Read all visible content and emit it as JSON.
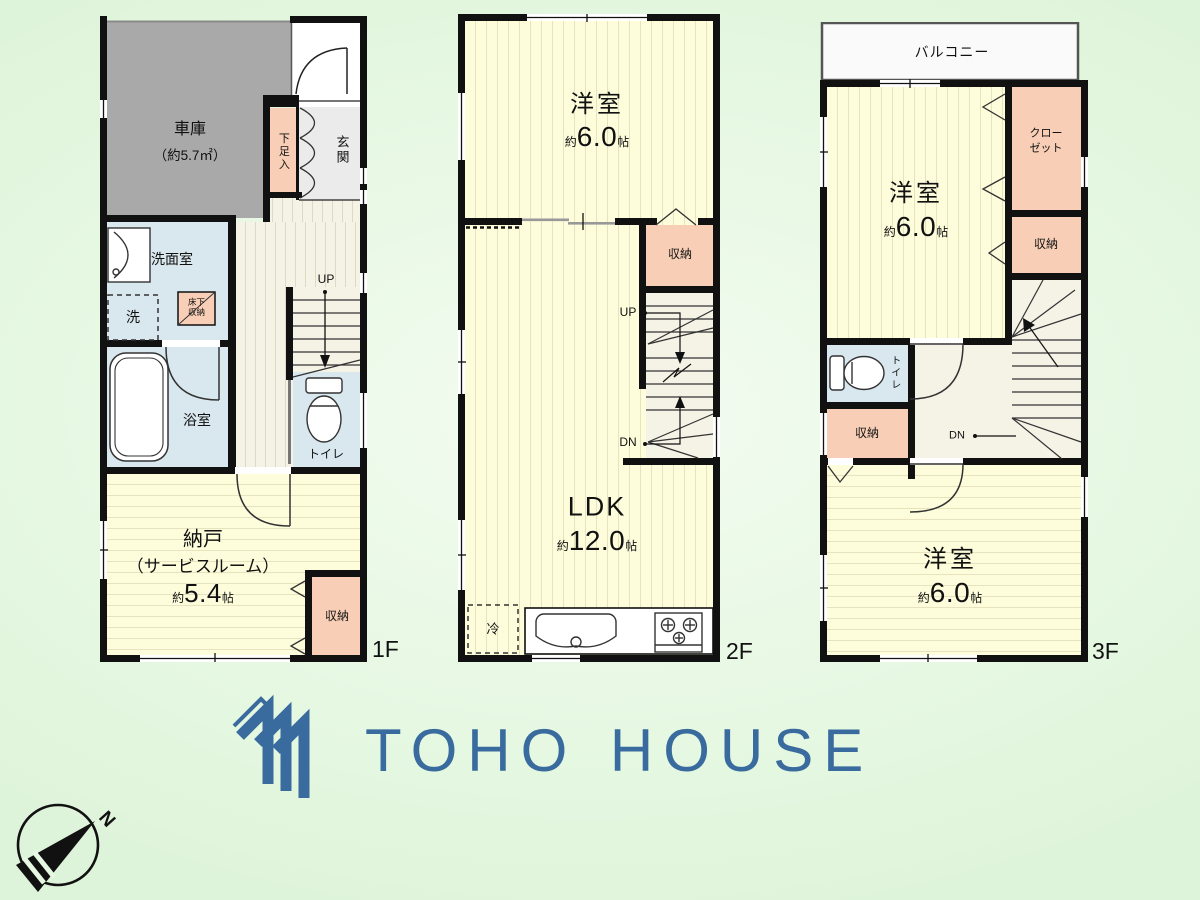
{
  "floor1": {
    "label": "1F",
    "garage_name": "車庫",
    "garage_area": "（約5.7㎡）",
    "shoe_box": "下足入",
    "entrance": "玄関",
    "washroom": "洗面室",
    "washer": "洗",
    "underfloor_line1": "床下",
    "underfloor_line2": "収納",
    "up": "UP",
    "toilet": "トイレ",
    "bath": "浴室",
    "storeroom_name": "納戸",
    "storeroom_sub": "（サービスルーム）",
    "storeroom_size_prefix": "約",
    "storeroom_size_value": "5.4",
    "storeroom_size_unit": "帖",
    "closet": "収納"
  },
  "floor2": {
    "label": "2F",
    "room_name": "洋室",
    "room_size_prefix": "約",
    "room_size_value": "6.0",
    "room_size_unit": "帖",
    "closet": "収納",
    "up": "UP",
    "dn": "DN",
    "ldk_name": "LDK",
    "ldk_size_prefix": "約",
    "ldk_size_value": "12.0",
    "ldk_size_unit": "帖",
    "fridge": "冷"
  },
  "floor3": {
    "label": "3F",
    "balcony": "バルコニー",
    "room_top_name": "洋室",
    "room_top_size_prefix": "約",
    "room_top_size_value": "6.0",
    "room_top_size_unit": "帖",
    "closet_line1": "クロー",
    "closet_line2": "ゼット",
    "storage_right": "収納",
    "toilet": "トイレ",
    "storage_left": "収納",
    "dn": "DN",
    "room_bottom_name": "洋室",
    "room_bottom_size_prefix": "約",
    "room_bottom_size_value": "6.0",
    "room_bottom_size_unit": "帖"
  },
  "logo": {
    "text": "TOHO HOUSE",
    "color": "#3a6b9e"
  },
  "compass": {
    "label": "N"
  },
  "palette": {
    "room_yellow": "#fdfcdb",
    "closet_peach": "#f8cfb6",
    "wet_blue": "#d9e8ee",
    "garage_gray": "#a9a9a9",
    "hall_cream": "#f5f2e6",
    "wall_black": "#111111",
    "background_green": "#e6f8e2"
  }
}
